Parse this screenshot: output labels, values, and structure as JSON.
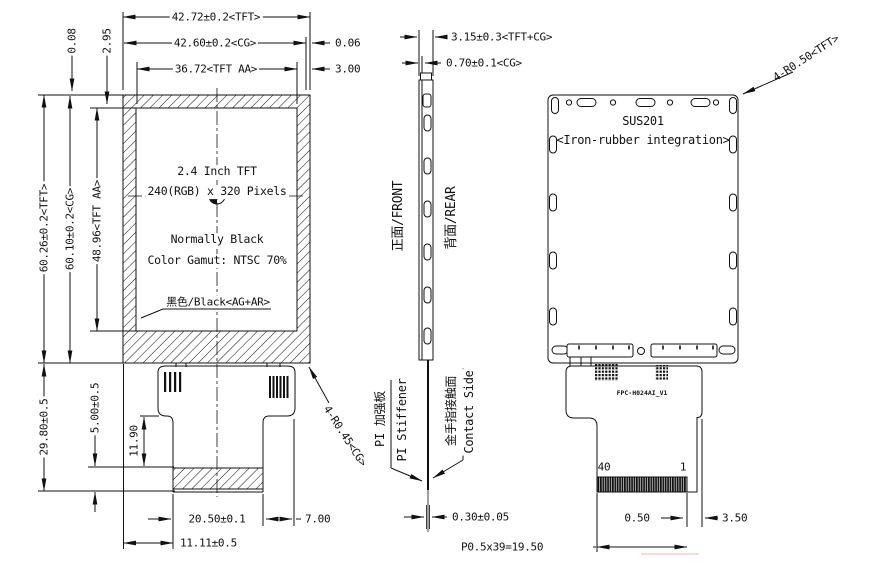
{
  "front_view": {
    "dims": {
      "tft_width": "42.72±0.2<TFT>",
      "cg_width": "42.60±0.2<CG>",
      "cg_right_offset": "0.06",
      "aa_width": "36.72<TFT AA>",
      "aa_right_margin": "3.00",
      "cg_top_offset": "0.08",
      "aa_top_offset": "2.95",
      "tft_height": "60.26±0.2<TFT>",
      "cg_height": "60.10±0.2<CG>",
      "aa_height": "48.96<TFT AA>",
      "module_lower_height": "29.80±0.5",
      "stiffener_height": "5.00±0.5",
      "fpc_tab_height": "11.90",
      "stiffener_width": "20.50±0.1",
      "tab_right_margin": "7.00",
      "tab_left_offset": "11.11±0.5",
      "corner_radius": "4-R0.45<CG>"
    },
    "panel": {
      "size": "2.4 Inch TFT",
      "resolution": "240(RGB) x 320 Pixels",
      "mode": "Normally Black",
      "gamut": "Color Gamut: NTSC 70%",
      "surface": "黑色/Black<AG+AR>"
    }
  },
  "side_view": {
    "dims": {
      "total_thickness": "3.15±0.3<TFT+CG>",
      "cg_thickness": "0.70±0.1<CG>",
      "fpc_thickness": "0.30±0.05"
    },
    "labels": {
      "front": "正面/FRONT",
      "rear": "背面/REAR",
      "stiffener_cn": "PI 加强板",
      "stiffener_en": "PI Stiffener",
      "contact_cn": "金手指接触面",
      "contact_en": "Contact Side"
    }
  },
  "rear_view": {
    "labels": {
      "material": "SUS201",
      "material_note": "<Iron-rubber integration>",
      "fpc_part": "FPC-H024AI_V1",
      "pin_last": "40",
      "pin_first": "1"
    },
    "dims": {
      "corner_radius": "4-R0.50<TFT>",
      "pin_width": "0.50",
      "edge_margin": "3.50",
      "pitch": "P0.5x39=19.50"
    }
  },
  "colors": {
    "line": "#1a1a1a",
    "background": "#ffffff"
  }
}
